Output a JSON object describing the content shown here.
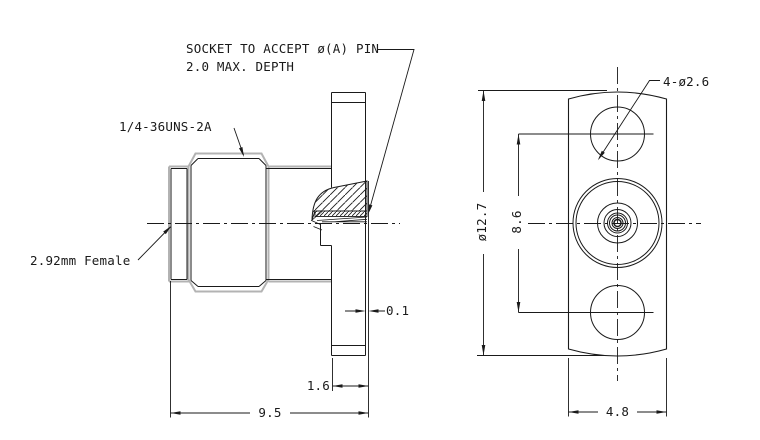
{
  "drawing": {
    "note": {
      "line1": "SOCKET TO ACCEPT ø(A) PIN",
      "line2": "2.0 MAX. DEPTH"
    },
    "labels": {
      "thread_spec": "1/4-36UNS-2A",
      "connector_type": "2.92mm Female",
      "mounting_holes": "4-ø2.6"
    },
    "dimensions": {
      "boss_height": "0.1",
      "flange_thickness": "1.6",
      "overall_length": "9.5",
      "flange_width": "4.8",
      "flange_diameter": "ø12.7",
      "hole_spacing": "8.6"
    },
    "colors": {
      "line": "#1a1a1a",
      "silhouette": "#b3b3b3",
      "background": "#ffffff"
    }
  }
}
